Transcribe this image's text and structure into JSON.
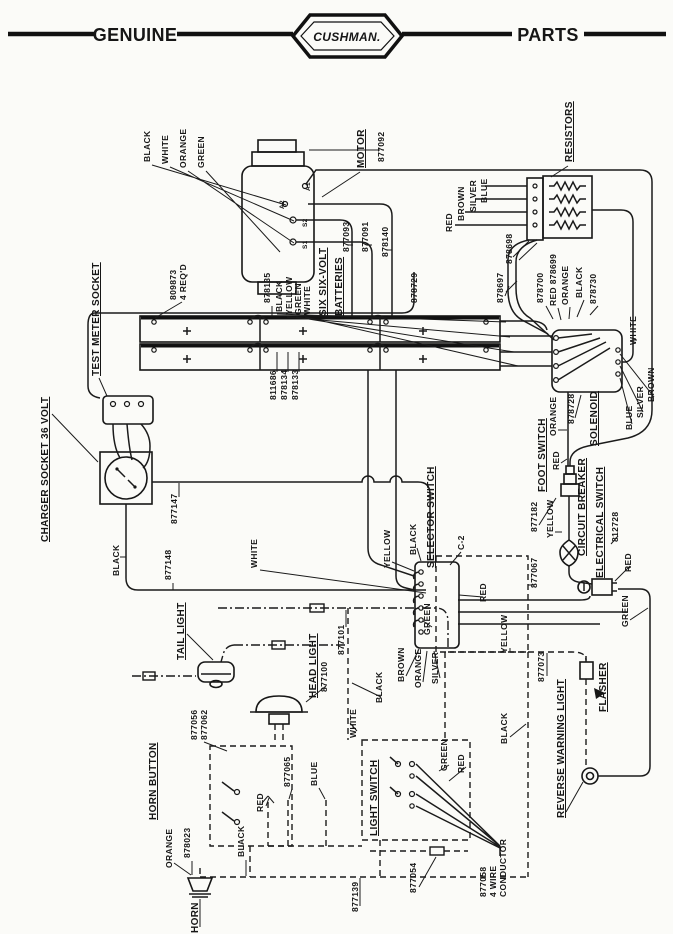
{
  "header": {
    "left_label": "GENUINE",
    "brand": "CUSHMAN.",
    "right_label": "PARTS"
  },
  "diagram": {
    "labels": [
      {
        "n": "wire-black-motor",
        "t": "BLACK",
        "x": 150,
        "y": 162
      },
      {
        "n": "wire-white-motor",
        "t": "WHITE",
        "x": 168,
        "y": 164
      },
      {
        "n": "wire-orange-motor",
        "t": "ORANGE",
        "x": 186,
        "y": 168
      },
      {
        "n": "wire-green-motor",
        "t": "GREEN",
        "x": 204,
        "y": 168
      },
      {
        "n": "label-motor",
        "t": "MOTOR",
        "x": 364,
        "y": 168,
        "u": 1,
        "s": 10
      },
      {
        "n": "part-877092",
        "t": "877092",
        "x": 384,
        "y": 162
      },
      {
        "n": "terminal-a1",
        "t": "A1",
        "x": 310,
        "y": 191,
        "s": 6.5
      },
      {
        "n": "terminal-a2",
        "t": "A2",
        "x": 284,
        "y": 209,
        "s": 6.5
      },
      {
        "n": "terminal-s2",
        "t": "S2",
        "x": 307,
        "y": 227,
        "s": 6.5
      },
      {
        "n": "terminal-s1",
        "t": "S1",
        "x": 307,
        "y": 249,
        "s": 6.5
      },
      {
        "n": "part-877093",
        "t": "877093",
        "x": 349,
        "y": 252
      },
      {
        "n": "part-877091",
        "t": "877091",
        "x": 368,
        "y": 252
      },
      {
        "n": "part-878140",
        "t": "878140",
        "x": 388,
        "y": 257
      },
      {
        "n": "label-resistors",
        "t": "RESISTORS",
        "x": 572,
        "y": 162,
        "u": 1,
        "s": 10
      },
      {
        "n": "wire-red-resistor",
        "t": "RED",
        "x": 452,
        "y": 232
      },
      {
        "n": "wire-brown-resistor",
        "t": "BROWN",
        "x": 464,
        "y": 221
      },
      {
        "n": "wire-silver-resistor",
        "t": "SILVER",
        "x": 476,
        "y": 212
      },
      {
        "n": "wire-blue-resistor",
        "t": "BLUE",
        "x": 487,
        "y": 203
      },
      {
        "n": "part-878698",
        "t": "878698",
        "x": 512,
        "y": 264
      },
      {
        "n": "part-878697",
        "t": "878697",
        "x": 503,
        "y": 303
      },
      {
        "n": "part-878700",
        "t": "878700",
        "x": 543,
        "y": 303
      },
      {
        "n": "part-878699",
        "t": "RED 878699",
        "x": 556,
        "y": 306
      },
      {
        "n": "wire-orange-solenoid-top",
        "t": "ORANGE",
        "x": 568,
        "y": 305
      },
      {
        "n": "wire-black-solenoid-top",
        "t": "BLACK",
        "x": 582,
        "y": 298
      },
      {
        "n": "part-878730",
        "t": "878730",
        "x": 596,
        "y": 304
      },
      {
        "n": "part-878729",
        "t": "878729",
        "x": 417,
        "y": 303
      },
      {
        "n": "wire-white-solenoid",
        "t": "WHITE",
        "x": 636,
        "y": 345
      },
      {
        "n": "part-809873",
        "t": "809873",
        "x": 176,
        "y": 300
      },
      {
        "n": "part-809873-qty",
        "t": "4 REQ'D",
        "x": 186,
        "y": 300
      },
      {
        "n": "part-878135",
        "t": "878135",
        "x": 270,
        "y": 303
      },
      {
        "n": "wire-black-battery",
        "t": "BLACK",
        "x": 282,
        "y": 312
      },
      {
        "n": "wire-yellow-battery",
        "t": "YELLOW",
        "x": 292,
        "y": 315
      },
      {
        "n": "wire-green-battery",
        "t": "GREEN",
        "x": 301,
        "y": 315
      },
      {
        "n": "wire-white-battery",
        "t": "WHITE",
        "x": 310,
        "y": 315
      },
      {
        "n": "label-six-six-volt",
        "t": "SIX SIX-VOLT",
        "x": 326,
        "y": 316,
        "u": 1,
        "s": 10
      },
      {
        "n": "label-batteries",
        "t": "BATTERIES",
        "x": 342,
        "y": 316,
        "u": 1,
        "s": 10
      },
      {
        "n": "part-811686",
        "t": "811686",
        "x": 276,
        "y": 400
      },
      {
        "n": "part-878134",
        "t": "878134",
        "x": 287,
        "y": 400
      },
      {
        "n": "part-878133",
        "t": "878133",
        "x": 298,
        "y": 400
      },
      {
        "n": "label-test-meter-socket",
        "t": "TEST METER SOCKET",
        "x": 99,
        "y": 376,
        "u": 1,
        "s": 10
      },
      {
        "n": "label-charger-socket",
        "t": "CHARGER SOCKET 36 VOLT",
        "x": 48,
        "y": 542,
        "u": 1,
        "s": 10
      },
      {
        "n": "part-877147",
        "t": "877147",
        "x": 177,
        "y": 524
      },
      {
        "n": "wire-black-charger",
        "t": "BLACK",
        "x": 119,
        "y": 576
      },
      {
        "n": "part-877148",
        "t": "877148",
        "x": 171,
        "y": 580
      },
      {
        "n": "wire-white-bus",
        "t": "WHITE",
        "x": 257,
        "y": 568
      },
      {
        "n": "label-selector-switch",
        "t": "SELECTOR SWITCH",
        "x": 434,
        "y": 568,
        "u": 1,
        "s": 10
      },
      {
        "n": "wire-yellow-selector",
        "t": "YELLOW",
        "x": 390,
        "y": 568
      },
      {
        "n": "wire-black-selector",
        "t": "BLACK",
        "x": 416,
        "y": 555
      },
      {
        "n": "label-c2",
        "t": "C-2",
        "x": 464,
        "y": 550
      },
      {
        "n": "wire-red-selector",
        "t": "RED",
        "x": 486,
        "y": 602
      },
      {
        "n": "wire-green-selector",
        "t": "GREEN",
        "x": 430,
        "y": 635
      },
      {
        "n": "part-877067",
        "t": "877067",
        "x": 537,
        "y": 588
      },
      {
        "n": "wire-brown-selector",
        "t": "BROWN",
        "x": 404,
        "y": 682
      },
      {
        "n": "wire-orange-selector",
        "t": "ORANGE",
        "x": 421,
        "y": 688
      },
      {
        "n": "wire-silver-selector",
        "t": "SILVER",
        "x": 438,
        "y": 684
      },
      {
        "n": "label-solenoid",
        "t": "SOLENOID",
        "x": 597,
        "y": 446,
        "u": 1,
        "s": 10
      },
      {
        "n": "part-878728",
        "t": "878728",
        "x": 574,
        "y": 424
      },
      {
        "n": "wire-orange-foot",
        "t": "ORANGE",
        "x": 556,
        "y": 436
      },
      {
        "n": "label-foot-switch",
        "t": "FOOT SWITCH",
        "x": 545,
        "y": 492,
        "u": 1,
        "s": 10
      },
      {
        "n": "part-877182",
        "t": "877182",
        "x": 537,
        "y": 532
      },
      {
        "n": "wire-red-foot",
        "t": "RED",
        "x": 559,
        "y": 470
      },
      {
        "n": "wire-yellow-breaker",
        "t": "YELLOW",
        "x": 553,
        "y": 538
      },
      {
        "n": "label-circuit-breaker",
        "t": "CIRCUIT BREAKER",
        "x": 585,
        "y": 556,
        "u": 1,
        "s": 10
      },
      {
        "n": "label-electrical-switch",
        "t": "ELECTRICAL SWITCH",
        "x": 603,
        "y": 578,
        "u": 1,
        "s": 10
      },
      {
        "n": "part-812728",
        "t": "812728",
        "x": 618,
        "y": 542
      },
      {
        "n": "wire-red-electrical",
        "t": "RED",
        "x": 631,
        "y": 572
      },
      {
        "n": "wire-green-electrical",
        "t": "GREEN",
        "x": 628,
        "y": 627
      },
      {
        "n": "wire-blue-solenoid",
        "t": "BLUE",
        "x": 632,
        "y": 430
      },
      {
        "n": "wire-silver-solenoid",
        "t": "SILVER",
        "x": 643,
        "y": 418
      },
      {
        "n": "wire-brown-solenoid",
        "t": "BROWN",
        "x": 654,
        "y": 402
      },
      {
        "n": "label-tail-light",
        "t": "TAIL LIGHT",
        "x": 184,
        "y": 660,
        "u": 1,
        "s": 10
      },
      {
        "n": "label-head-light",
        "t": "HEAD LIGHT",
        "x": 316,
        "y": 698,
        "u": 1,
        "s": 10
      },
      {
        "n": "part-877101",
        "t": "877101",
        "x": 344,
        "y": 655
      },
      {
        "n": "part-877100",
        "t": "877100",
        "x": 327,
        "y": 692
      },
      {
        "n": "wire-white-headlight",
        "t": "WHITE",
        "x": 356,
        "y": 738
      },
      {
        "n": "wire-black-headlight",
        "t": "BLACK",
        "x": 382,
        "y": 703
      },
      {
        "n": "part-877056",
        "t": "877056",
        "x": 197,
        "y": 740
      },
      {
        "n": "part-877062",
        "t": "877062",
        "x": 207,
        "y": 740
      },
      {
        "n": "label-horn-button",
        "t": "HORN BUTTON",
        "x": 156,
        "y": 820,
        "u": 1,
        "s": 10
      },
      {
        "n": "wire-orange-horn",
        "t": "ORANGE",
        "x": 172,
        "y": 868
      },
      {
        "n": "part-878023",
        "t": "878023",
        "x": 190,
        "y": 858
      },
      {
        "n": "wire-black-horn",
        "t": "BLACK",
        "x": 244,
        "y": 857
      },
      {
        "n": "label-horn",
        "t": "HORN",
        "x": 198,
        "y": 933,
        "s": 10
      },
      {
        "n": "part-877139",
        "t": "877139",
        "x": 358,
        "y": 912
      },
      {
        "n": "wire-red-lightswitch",
        "t": "RED",
        "x": 263,
        "y": 812
      },
      {
        "n": "part-877065",
        "t": "877065",
        "x": 290,
        "y": 787
      },
      {
        "n": "wire-blue-lightswitch",
        "t": "BLUE",
        "x": 317,
        "y": 786
      },
      {
        "n": "label-light-switch",
        "t": "LIGHT SWITCH",
        "x": 377,
        "y": 836,
        "u": 1,
        "s": 10
      },
      {
        "n": "wire-green-conductor",
        "t": "GREEN",
        "x": 447,
        "y": 771
      },
      {
        "n": "wire-red-conductor",
        "t": "RED",
        "x": 464,
        "y": 773
      },
      {
        "n": "part-877054",
        "t": "877054",
        "x": 416,
        "y": 893
      },
      {
        "n": "part-877058",
        "t": "877058",
        "x": 486,
        "y": 897
      },
      {
        "n": "part-877058-line2",
        "t": "4 WIRE",
        "x": 496,
        "y": 897
      },
      {
        "n": "part-877058-line3",
        "t": "CONDUCTOR",
        "x": 506,
        "y": 897
      },
      {
        "n": "wire-yellow-flasher",
        "t": "YELLOW",
        "x": 507,
        "y": 653
      },
      {
        "n": "part-877073",
        "t": "877073",
        "x": 544,
        "y": 682
      },
      {
        "n": "wire-black-reverse",
        "t": "BLACK",
        "x": 507,
        "y": 744
      },
      {
        "n": "label-flasher",
        "t": "FLASHER",
        "x": 606,
        "y": 712,
        "u": 1,
        "s": 10
      },
      {
        "n": "label-reverse-warning",
        "t": "REVERSE WARNING LIGHT",
        "x": 564,
        "y": 818,
        "u": 1,
        "s": 10
      }
    ]
  }
}
